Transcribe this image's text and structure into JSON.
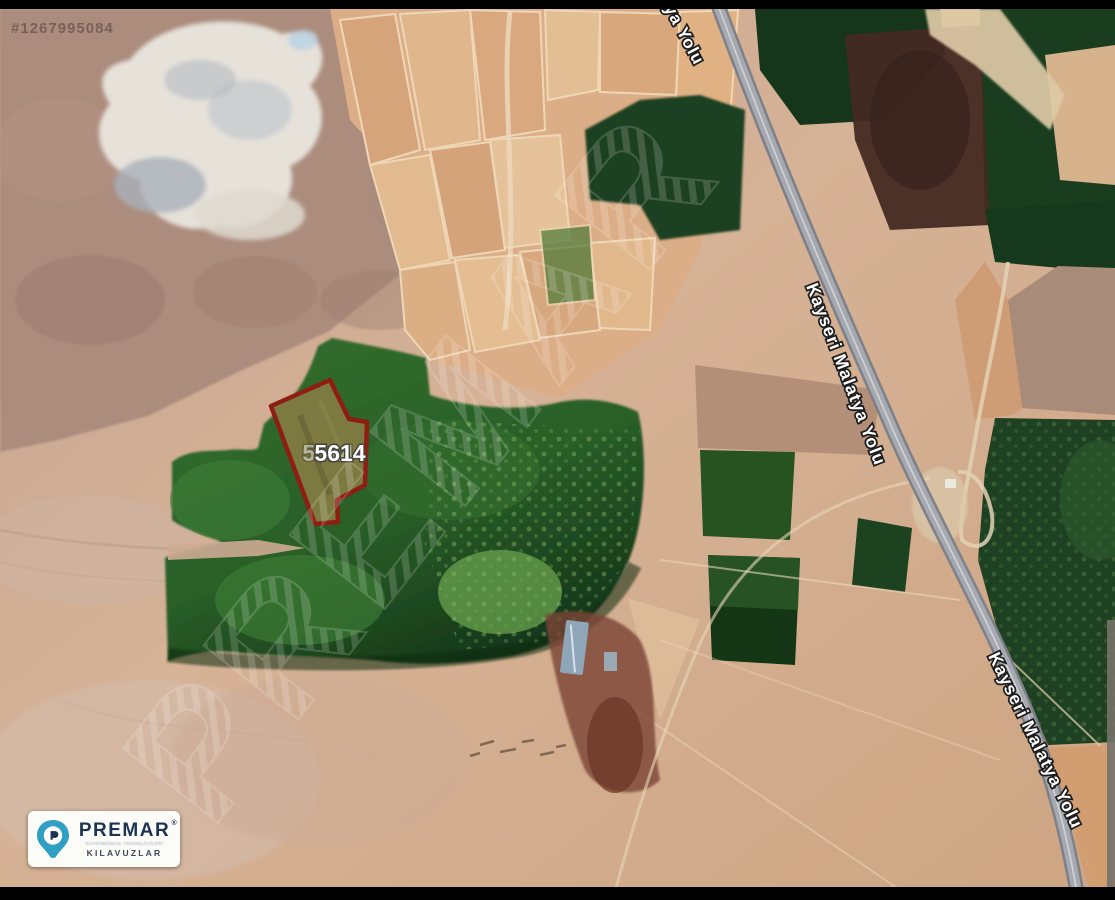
{
  "watermarks": {
    "listing_id": "#1267995084",
    "diagonal_text": "PREMAR"
  },
  "map": {
    "parcel_label": "5614",
    "road_name": "Kayseri Malatya Yolu",
    "road_name_partial": "ya Yolu"
  },
  "logo": {
    "brand": "PREMAR",
    "registered_mark": "®",
    "tagline": "GAYRİMENKUL TEKNOLOJİLERİ",
    "division": "KILAVUZLAR"
  },
  "colors": {
    "parcel_outline": "#8e1d12",
    "parcel_fill": "#7d7a41",
    "road_fill": "#a7a9b0",
    "forest_green": "#1d4520",
    "field_tan": "#dcae87",
    "quarry_white": "#e8e5de",
    "logo_accent": "#2f9fc4",
    "logo_navy": "#1d3354",
    "letterbox": "#000000"
  }
}
